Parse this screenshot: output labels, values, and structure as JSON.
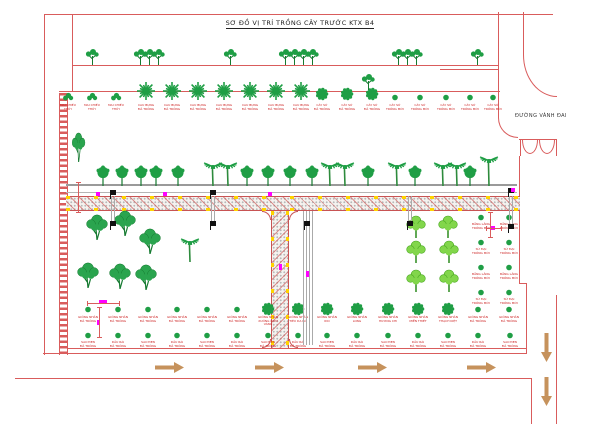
{
  "title": "SƠ ĐỒ VỊ TRÍ TRỒNG CÂY TRƯỚC KTX B4",
  "road_label": "ĐƯỜNG VÀNH ĐAI",
  "colors": {
    "line_red": "#d95c5c",
    "dark_red_text": "#cc2222",
    "tree_green": "#1f9e45",
    "light_green": "#82d64b",
    "magenta": "#ff00ff",
    "yellow": "#ffd400",
    "arrow_tan": "#c6925c",
    "road_gray": "#9a9a9a",
    "black": "#111111"
  },
  "top_row_trees": {
    "type": "small-tree",
    "x": [
      92,
      140,
      149,
      158,
      230,
      285,
      294,
      303,
      312,
      398,
      407,
      416,
      477
    ],
    "baseline_y": 65
  },
  "yard_row": {
    "baseline_y": 97,
    "label_y": 104,
    "items": [
      {
        "x": 68,
        "type": "bush",
        "label": [
          "MAI CHIẾU",
          "THỦY"
        ]
      },
      {
        "x": 92,
        "type": "bush",
        "label": [
          "MAI CHIẾU",
          "THỦY"
        ]
      },
      {
        "x": 116,
        "type": "bush",
        "label": [
          "MAI CHIẾU",
          "THỦY"
        ]
      },
      {
        "x": 146,
        "type": "star",
        "label": [
          "CAU BỤNG",
          "ĐÃ TRỒNG"
        ]
      },
      {
        "x": 172,
        "type": "star",
        "label": [
          "CAU BỤNG",
          "ĐÃ TRỒNG"
        ]
      },
      {
        "x": 198,
        "type": "star",
        "label": [
          "CAU BỤNG",
          "ĐÃ TRỒNG"
        ]
      },
      {
        "x": 224,
        "type": "star",
        "label": [
          "CAU BỤNG",
          "ĐÃ TRỒNG"
        ]
      },
      {
        "x": 250,
        "type": "star",
        "label": [
          "CAU BỤNG",
          "ĐÃ TRỒNG"
        ]
      },
      {
        "x": 276,
        "type": "star",
        "label": [
          "CAU BỤNG",
          "ĐÃ TRỒNG"
        ]
      },
      {
        "x": 301,
        "type": "star",
        "label": [
          "CAU BỤNG",
          "ĐÃ TRỒNG"
        ]
      },
      {
        "x": 322,
        "type": "fluffy",
        "label": [
          "CÂY SỨ",
          "ĐÃ TRỒNG"
        ]
      },
      {
        "x": 347,
        "type": "fluffy",
        "label": [
          "CÂY SỨ",
          "ĐÃ TRỒNG"
        ]
      },
      {
        "x": 372,
        "type": "fluffy",
        "label": [
          "CÂY SỨ",
          "ĐÃ TRỒNG"
        ]
      },
      {
        "x": 395,
        "type": "dot",
        "label": [
          "CÂY SỨ",
          "TRỒNG MỚI"
        ]
      },
      {
        "x": 420,
        "type": "dot",
        "label": [
          "CÂY SỨ",
          "TRỒNG MỚI"
        ]
      },
      {
        "x": 446,
        "type": "dot",
        "label": [
          "CÂY SỨ",
          "TRỒNG MỚI"
        ]
      },
      {
        "x": 470,
        "type": "dot",
        "label": [
          "CÂY SỨ",
          "TRỒNG MỚI"
        ]
      },
      {
        "x": 493,
        "type": "dot",
        "label": [
          "CÂY SỨ",
          "TRỒNG MỚI"
        ]
      }
    ],
    "extra_tree": {
      "type": "small-tree",
      "x": 368,
      "base_y": 90
    }
  },
  "road_row": {
    "baseline_y": 186,
    "round_x": [
      103,
      122,
      141,
      156,
      178,
      247,
      268,
      290,
      312,
      368,
      415,
      470
    ],
    "palm_x": [
      213,
      228,
      330,
      345,
      397,
      443,
      457
    ],
    "tall_palm_x": [
      489
    ]
  },
  "field_trees": [
    {
      "x": 97,
      "y": 240,
      "type": "big"
    },
    {
      "x": 125,
      "y": 236,
      "type": "big"
    },
    {
      "x": 150,
      "y": 254,
      "type": "big"
    },
    {
      "x": 88,
      "y": 288,
      "type": "big"
    },
    {
      "x": 120,
      "y": 289,
      "type": "big"
    },
    {
      "x": 146,
      "y": 290,
      "type": "big"
    },
    {
      "x": 190,
      "y": 262,
      "type": "palm"
    },
    {
      "x": 78,
      "y": 162,
      "type": "tall"
    }
  ],
  "light_green_trees": [
    {
      "x": 416,
      "y": 238
    },
    {
      "x": 448,
      "y": 238
    },
    {
      "x": 416,
      "y": 263
    },
    {
      "x": 449,
      "y": 263
    },
    {
      "x": 416,
      "y": 292
    },
    {
      "x": 449,
      "y": 292
    }
  ],
  "column_trees": {
    "columns_x": [
      481,
      509
    ],
    "rows_y": [
      218,
      243,
      268,
      293
    ],
    "labels": [
      [
        "BẰNG LĂNG",
        "TRỒNG MỚI"
      ],
      [
        "SỨ ĐẠI",
        "TRỒNG MỚI"
      ],
      [
        "BẰNG LĂNG",
        "TRỒNG MỚI"
      ],
      [
        "SỨ ĐẠI",
        "TRỒNG MỚI"
      ]
    ]
  },
  "row_a": {
    "y": 310,
    "label_y": 316,
    "dots_x": [
      88,
      118,
      148,
      177,
      207,
      237,
      478,
      509
    ],
    "dot_label": [
      "GIỐNG NHÃN",
      "ĐÃ TRỒNG"
    ],
    "fluffy_x": [
      268,
      298,
      327,
      357,
      388,
      418,
      448
    ],
    "fluffy_labels": [
      [
        "GIỐNG NHÃN",
        "XUỒNG CƠM VÀNG"
      ],
      [
        "GIỐNG NHÃN",
        "TIÊU DA BÒ"
      ],
      [
        "GIỐNG NHÃN",
        "IDO"
      ],
      [
        "GIỐNG NHÃN",
        "LONG"
      ],
      [
        "GIỐNG NHÃN",
        "HƯƠNG CHI"
      ],
      [
        "GIỐNG NHÃN",
        "MIỀN THIẾT"
      ],
      [
        "GIỐNG NHÃN",
        "THẠCH KIỆT"
      ]
    ]
  },
  "row_b": {
    "y": 336,
    "label_y": 341,
    "x": [
      88,
      118,
      148,
      177,
      207,
      237,
      268,
      298,
      327,
      357,
      388,
      418,
      448,
      478,
      510
    ],
    "labels": [
      [
        "SAO ĐEN",
        "ĐÃ TRỒNG"
      ],
      [
        "DẦU RÁI",
        "ĐÃ TRỒNG"
      ]
    ]
  },
  "arrows": {
    "right": [
      {
        "x": 155,
        "y": 362
      },
      {
        "x": 255,
        "y": 362
      },
      {
        "x": 358,
        "y": 362
      },
      {
        "x": 467,
        "y": 362
      }
    ],
    "down": [
      {
        "x": 536,
        "y": 333
      },
      {
        "x": 536,
        "y": 377
      }
    ]
  },
  "bollards": {
    "upper": [
      {
        "x": 110,
        "y": 190
      },
      {
        "x": 210,
        "y": 190
      },
      {
        "x": 508,
        "y": 188
      }
    ],
    "lower": [
      {
        "x": 110,
        "y": 221
      },
      {
        "x": 210,
        "y": 221
      },
      {
        "x": 304,
        "y": 221
      },
      {
        "x": 407,
        "y": 221
      },
      {
        "x": 508,
        "y": 224
      }
    ]
  },
  "guy_lines": [
    {
      "x": 111,
      "y1": 196,
      "y2": 221
    },
    {
      "x": 211,
      "y1": 196,
      "y2": 221
    },
    {
      "x": 408,
      "y1": 196,
      "y2": 221
    },
    {
      "x": 509,
      "y1": 196,
      "y2": 224
    },
    {
      "x": 303,
      "y1": 211,
      "y2": 345
    },
    {
      "x": 309,
      "y1": 211,
      "y2": 345
    }
  ],
  "magenta_marks": [
    {
      "x": 96,
      "y": 192,
      "w": 4,
      "h": 4
    },
    {
      "x": 163,
      "y": 192,
      "w": 4,
      "h": 4
    },
    {
      "x": 268,
      "y": 192,
      "w": 4,
      "h": 4
    },
    {
      "x": 511,
      "y": 188,
      "w": 4,
      "h": 4
    },
    {
      "x": 279,
      "y": 264,
      "w": 3,
      "h": 6
    },
    {
      "x": 306,
      "y": 271,
      "w": 3,
      "h": 6
    },
    {
      "x": 491,
      "y": 226,
      "w": 4,
      "h": 4
    },
    {
      "x": 97,
      "y": 320,
      "w": 3,
      "h": 5
    },
    {
      "x": 99,
      "y": 300,
      "w": 8,
      "h": 4
    }
  ],
  "dimensions": [
    {
      "kind": "h",
      "x1": 87,
      "x2": 119,
      "y": 303
    },
    {
      "kind": "v",
      "x": 99,
      "y1": 307,
      "y2": 337
    },
    {
      "kind": "v",
      "x": 78,
      "y1": 182,
      "y2": 212
    },
    {
      "kind": "v",
      "x": 490,
      "y1": 212,
      "y2": 237
    },
    {
      "kind": "h",
      "x1": 486,
      "x2": 501,
      "y": 228
    }
  ]
}
